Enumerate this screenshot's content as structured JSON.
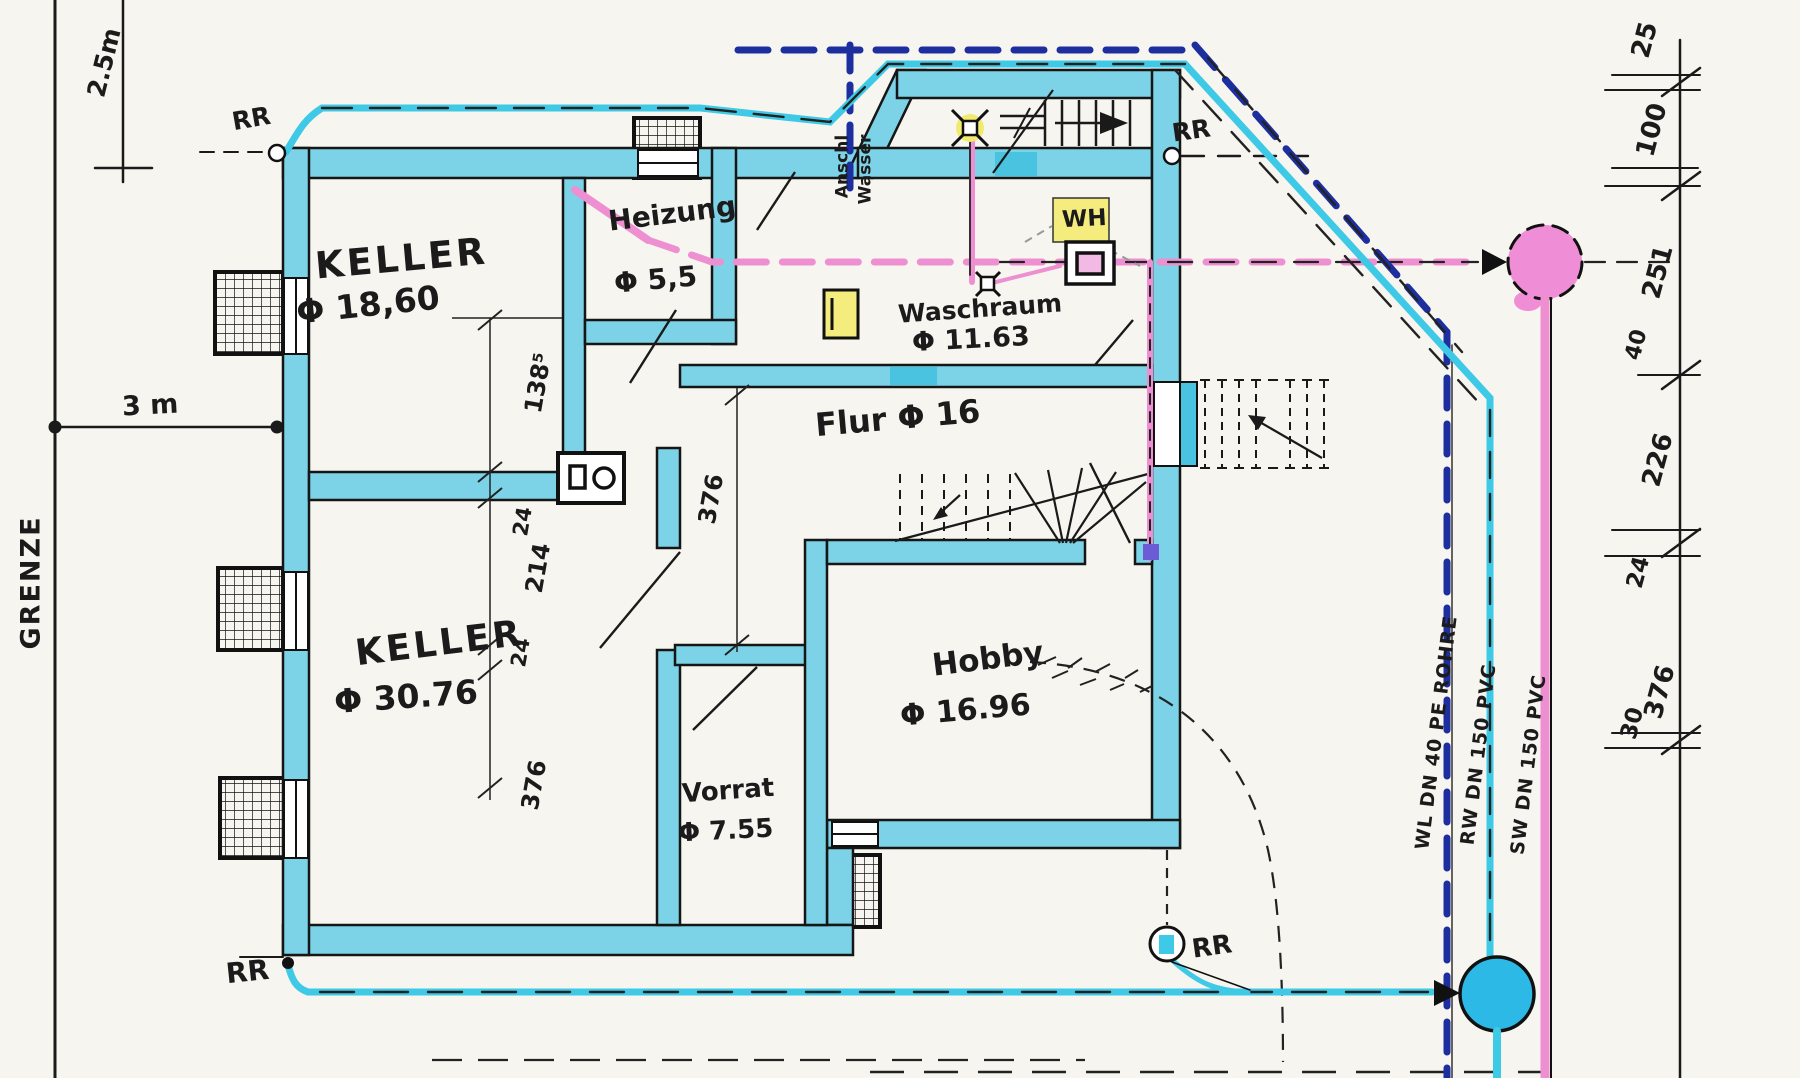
{
  "boundary": {
    "label": "GRENZE",
    "dim_top": "2.5m",
    "dim_left": "3 m"
  },
  "rooms": [
    {
      "name": "KELLER",
      "area": "Φ 18,60"
    },
    {
      "name": "Heizung",
      "area": "Φ 5,5"
    },
    {
      "name": "Waschraum",
      "area": "Φ 11.63"
    },
    {
      "name": "Flur Φ 16",
      "area": ""
    },
    {
      "name": "KELLER",
      "area": "Φ 30.76"
    },
    {
      "name": "Hobby",
      "area": "Φ 16.96"
    },
    {
      "name": "Vorrat",
      "area": "Φ 7.55"
    }
  ],
  "markers": {
    "rr": "RR",
    "wh": "WH",
    "anschluss": [
      "Anschl",
      "Wasser"
    ]
  },
  "pipes": [
    {
      "id": "wl",
      "label": "WL DN 40 PE ROHRE",
      "color": "#1d2f9f"
    },
    {
      "id": "rw",
      "label": "RW DN 150 PVC",
      "color": "#3ec9e6"
    },
    {
      "id": "sw",
      "label": "SW DN 150 PVC",
      "color": "#ee8fd2"
    }
  ],
  "dimensions": {
    "right_chain": [
      "25",
      "100",
      "251",
      "40",
      "226",
      "24",
      "376",
      "30"
    ],
    "interior": [
      "138⁵",
      "24",
      "214",
      "24",
      "376",
      "376"
    ]
  },
  "legend_colors": {
    "walls_highlight": "#7cd2e6",
    "water_supply": "#1d2f9f",
    "rain_water": "#3ec9e6",
    "sewage": "#ee8fd2",
    "fixture_highlight": "#f4ec7c"
  }
}
